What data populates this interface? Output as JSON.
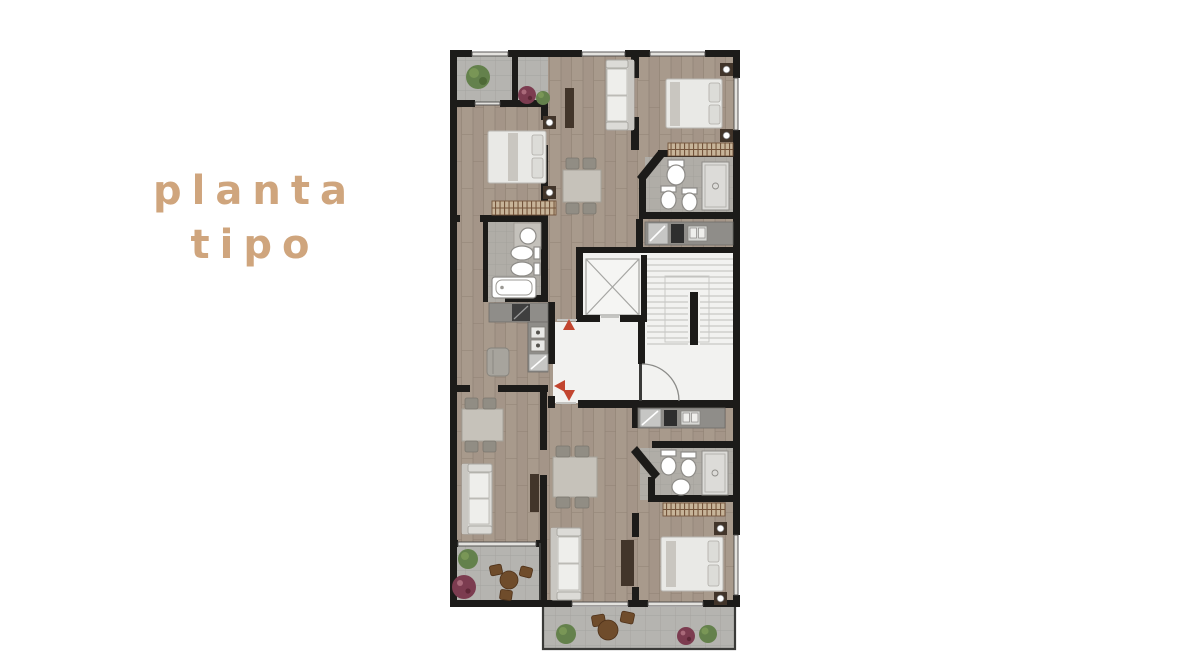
{
  "title": {
    "line1": "planta",
    "line2": "tipo"
  },
  "plan": {
    "entrance_markers": 3,
    "marker_shape": "red-triangle"
  },
  "colors": {
    "bg": "#ffffff",
    "title": "#cfa57d",
    "wall": "#1c1b19",
    "wood": "#a89a8c",
    "wood2": "#a09284",
    "wood3": "#8f8173",
    "tile": "#b5b4b0",
    "tile_line": "#a4a39f",
    "bath_tile": "#b0ada7",
    "bath_tile_line": "#a19e98",
    "core": "#f2f2f0",
    "stair_line": "#bdbdba",
    "fixture": "#ffffff",
    "fixture_stroke": "#8e8c88",
    "sofa": "#dcdbd7",
    "sofa_line": "#aaa8a3",
    "table": "#c6c2ba",
    "chair": "#918d84",
    "dark_wood": "#42352a",
    "counter": "#8f8d89",
    "metal": "#c6c6c4",
    "hatch_bg": "#c7b499",
    "hatch_line": "#74553c",
    "accent_red": "#c2452f",
    "window": "#e3e2de",
    "plant_green": "#64814c",
    "plant_green2": "#7d9a58",
    "plant_purple": "#7c3c50",
    "outdoor_brown": "#6f4c2b"
  }
}
